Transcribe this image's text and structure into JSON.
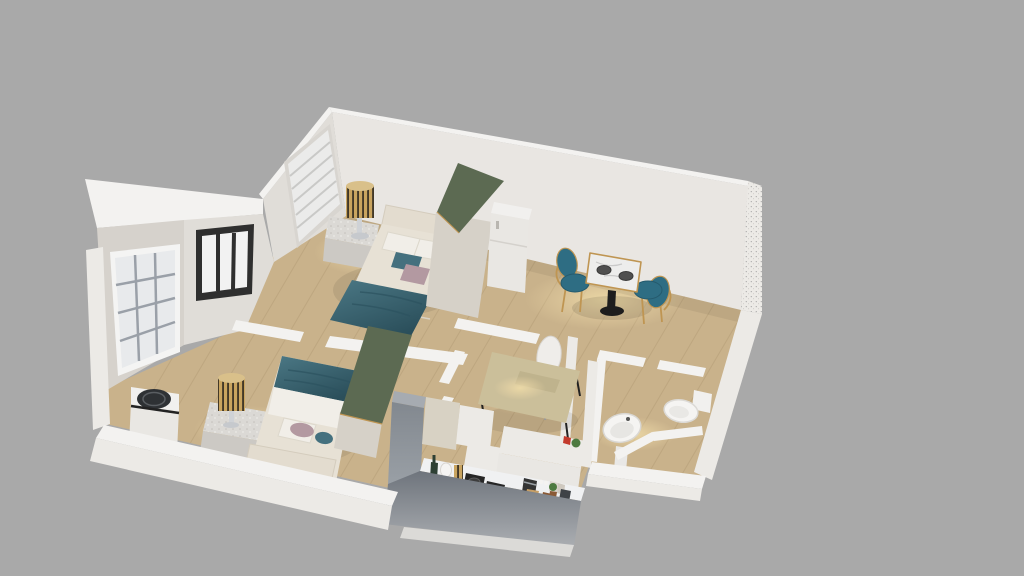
{
  "scene": {
    "type": "3d-apartment-floorplan-render",
    "view": "isometric-dollhouse-top",
    "background": "#a9a9a9"
  },
  "colors": {
    "background": "#a9a9a9",
    "wallLit": "#e9e6e2",
    "wallShade": "#e0ddd8",
    "wallDark": "#d6d2cc",
    "wallTop": "#f3f2f0",
    "wallBand": "#eceae6",
    "floorWood": "#c9b28b",
    "wardrobeGreen": "#5c6a52",
    "wardrobeBody": "#d6d1c8",
    "bedCream": "#e7e1d5",
    "headboardCream": "#e3dccf",
    "pillowWhite": "#f1eee8",
    "tealFabric": "#3d6b78",
    "tealPillow": "#44707e",
    "mauvePillow": "#b399a1",
    "gold": "#bf9552",
    "chairTeal": "#2e6d83",
    "marble": "#ededec",
    "plateGray": "#4f4f4f",
    "pedestalBlack": "#1d1d1d",
    "deskTan": "#cbbf9a",
    "deskShelf": "#bfb38d",
    "chairWhite": "#efedea",
    "granite": "#dcdad6",
    "graniteFront": "#ccc9c4",
    "applianceWhite": "#f1f0ee",
    "applianceFront": "#e9e7e3",
    "lidDark": "#2e3134",
    "cabinetGray": "#8f959c",
    "cabinetBeige": "#d8d2c4",
    "cabinetWhite": "#eceae6",
    "counterWhite": "#f0f1f2",
    "hobBlack": "#262626",
    "bottleGreen": "#2e4034",
    "canisterGold": "#c8a360",
    "plantGreen": "#4d7a40",
    "boardWood": "#c79f66",
    "brownPot": "#8a5a36",
    "binDark": "#3f4347",
    "redAccent": "#c33a2c",
    "fixtureWhite": "#f5f4f2",
    "windowDark": "#2f2f2f",
    "windowPane": "#f2f2f2",
    "mullionGray": "#9aa0a8",
    "baseSlab": "#dbdad7"
  },
  "rooms": [
    {
      "id": "bedroom-top",
      "kind": "bedroom",
      "furniture": [
        "single-bed",
        "teal-blanket",
        "nightstand",
        "striped-table-lamp",
        "green-top-wardrobe",
        "white-refrigerator-cabinet",
        "blinds-window"
      ]
    },
    {
      "id": "bedroom-left",
      "kind": "bedroom",
      "furniture": [
        "single-bed",
        "teal-blanket",
        "nightstand",
        "striped-table-lamp",
        "green-top-wardrobe",
        "washing-machine",
        "grid-window",
        "dark-frame-window"
      ]
    },
    {
      "id": "dining-area",
      "kind": "dining",
      "furniture": [
        "marble-pedestal-table",
        "dinner-plate",
        "dinner-plate",
        "teal-gold-chair",
        "teal-gold-chair"
      ]
    },
    {
      "id": "study-nook",
      "kind": "workspace",
      "furniture": [
        "writing-desk",
        "white-shell-chair"
      ]
    },
    {
      "id": "kitchen",
      "kind": "kitchen",
      "furniture": [
        "tall-gray-cabinet",
        "upper-cabinets",
        "counter-run",
        "gas-hob",
        "gas-hob",
        "wine-bottle",
        "jar",
        "gold-canister",
        "coffee-machine",
        "spice-jars",
        "potted-plant",
        "cutting-board",
        "brown-pot",
        "dark-bin",
        "red-accent-item"
      ]
    },
    {
      "id": "bathroom",
      "kind": "bathroom",
      "furniture": [
        "pedestal-sink",
        "toilet"
      ]
    }
  ]
}
